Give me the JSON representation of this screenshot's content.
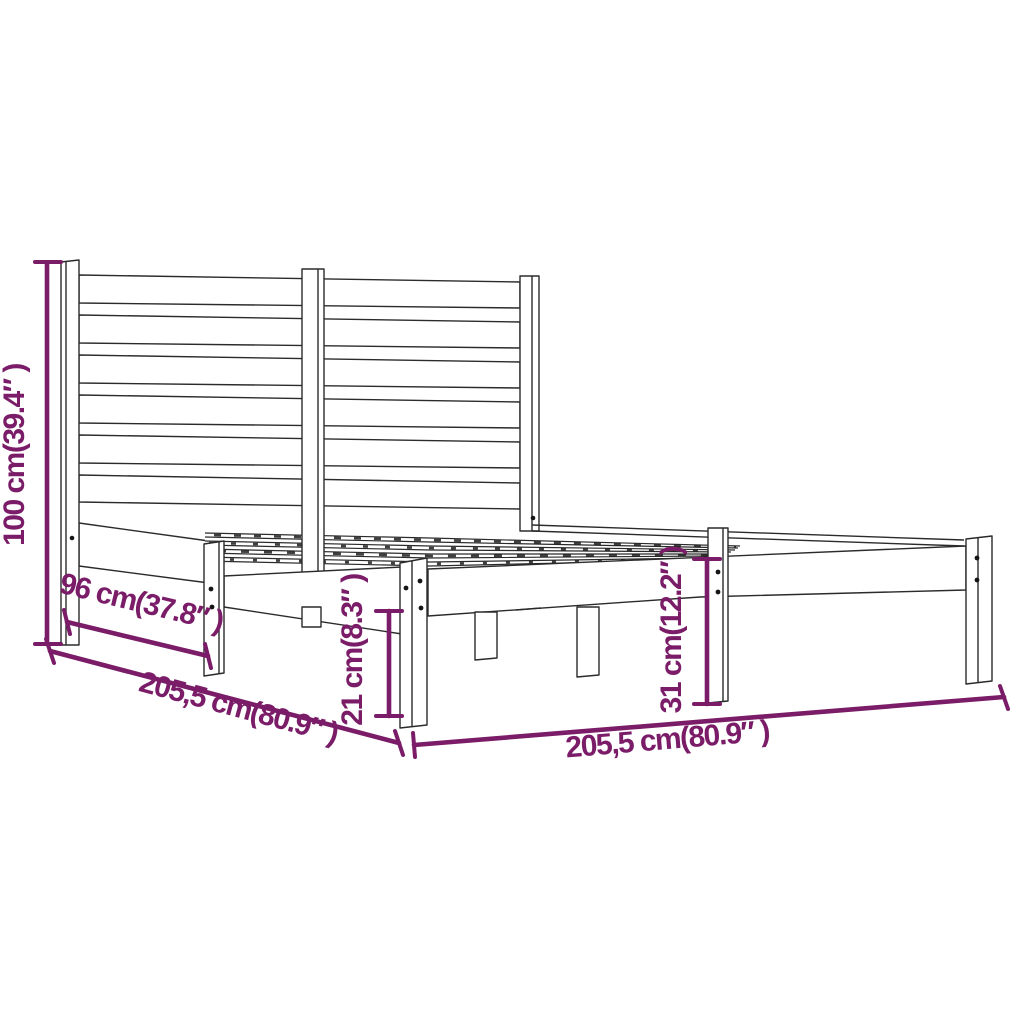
{
  "diagram": {
    "kind": "product-dimension-line-drawing",
    "subject": "bed-frame-with-slatted-headboard",
    "background_color": "#ffffff",
    "accent_color": "#7A1C67",
    "line_color": "#2b2b2b",
    "dimensions": {
      "headboard_height": {
        "label": "100 cm(39.4″ )",
        "cm": "100",
        "inches": "39.4",
        "orientation": "vertical-left"
      },
      "headboard_to_side_leg": {
        "label": "96 cm(37.8″ )",
        "cm": "96",
        "inches": "37.8",
        "orientation": "diagonal-lower-left"
      },
      "width": {
        "label": "205,5 cm(80.9″ )",
        "cm": "205,5",
        "inches": "80.9",
        "orientation": "diagonal-lower-left"
      },
      "rail_ground_clearance": {
        "label": "21 cm(8.3″ )",
        "cm": "21",
        "inches": "8.3",
        "orientation": "vertical-middle"
      },
      "base_height": {
        "label": "31 cm(12.2″ )",
        "cm": "31",
        "inches": "12.2",
        "orientation": "vertical-right"
      },
      "length": {
        "label": "205,5 cm(80.9″ )",
        "cm": "205,5",
        "inches": "80.9",
        "orientation": "bottom"
      }
    }
  }
}
